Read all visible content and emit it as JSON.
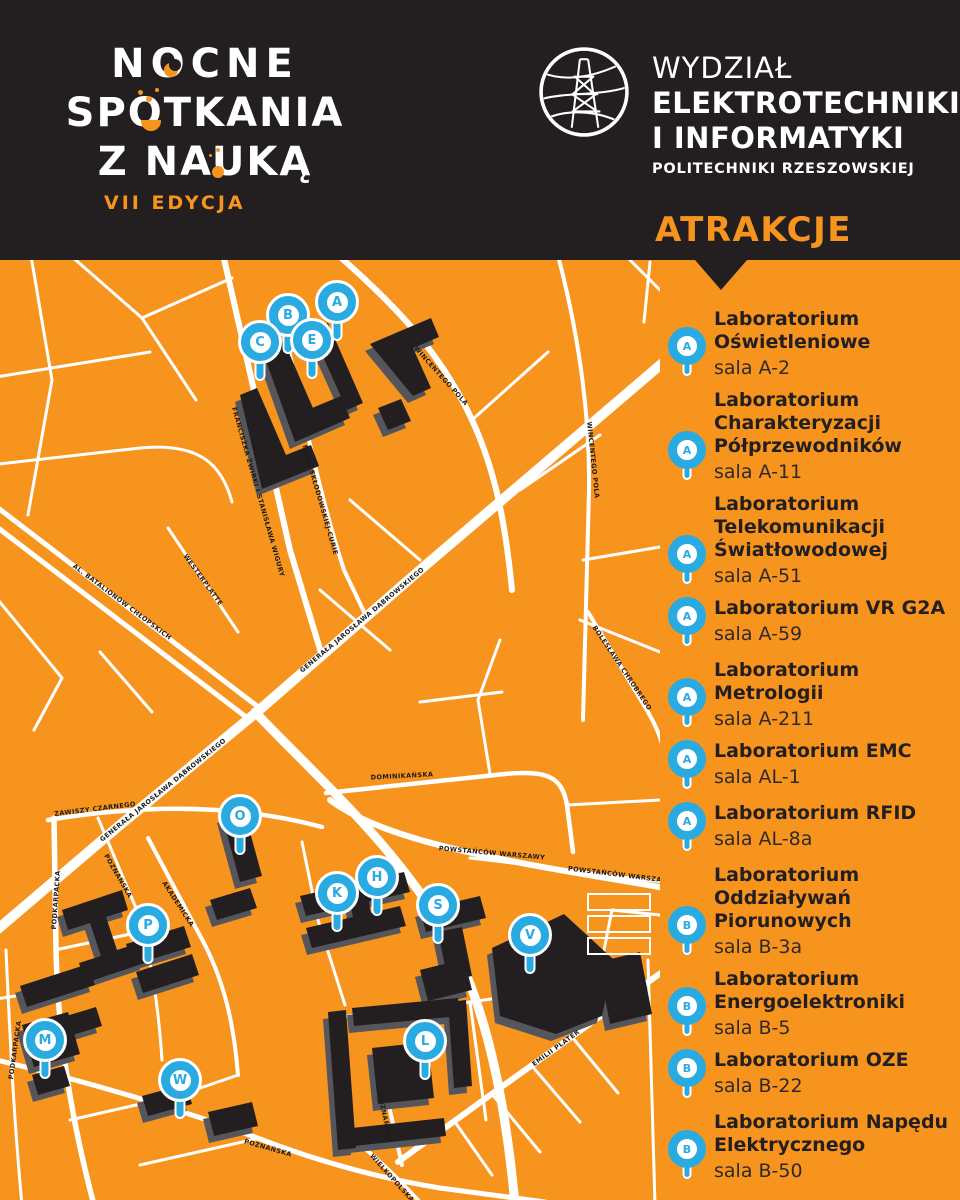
{
  "colors": {
    "orange": "#F7941E",
    "dark": "#231F20",
    "blue": "#29ABE2",
    "gray": "#54565B"
  },
  "header": {
    "event_logo": {
      "line1": "NOCNE",
      "line2": "SPOTKANIA",
      "line3": "Z NAUKĄ",
      "edition": "VII EDYCJA"
    },
    "faculty_logo": {
      "line1": "WYDZIAŁ",
      "line2": "ELEKTROTECHNIKI",
      "line3": "I INFORMATYKI",
      "line4": "POLITECHNIKI RZESZOWSKIEJ"
    }
  },
  "attractions": {
    "title": "ATRAKCJE",
    "items": [
      {
        "pin": "A",
        "name": "Laboratorium\nOświetleniowe",
        "room": "sala A-2"
      },
      {
        "pin": "A",
        "name": "Laboratorium\nCharakteryzacji\nPółprzewodników",
        "room": "sala A-11"
      },
      {
        "pin": "A",
        "name": "Laboratorium\nTelekomunikacji\nŚwiatłowodowej",
        "room": "sala A-51"
      },
      {
        "pin": "A",
        "name": "Laboratorium VR G2A",
        "room": "sala A-59"
      },
      {
        "pin": "A",
        "name": "Laboratorium\nMetrologii",
        "room": "sala A-211"
      },
      {
        "pin": "A",
        "name": "Laboratorium EMC",
        "room": "sala AL-1"
      },
      {
        "pin": "A",
        "name": "Laboratorium RFID",
        "room": "sala AL-8a"
      },
      {
        "pin": "B",
        "name": "Laboratorium\nOddziaływań\nPiorunowych",
        "room": "sala B-3a"
      },
      {
        "pin": "B",
        "name": "Laboratorium\nEnergoelektroniki",
        "room": "sala B-5"
      },
      {
        "pin": "B",
        "name": "Laboratorium OZE",
        "room": "sala B-22"
      },
      {
        "pin": "B",
        "name": "Laboratorium Napędu\nElektrycznego",
        "room": "sala B-50"
      }
    ]
  },
  "map": {
    "markers": [
      {
        "letter": "A",
        "x": 337,
        "y": 42
      },
      {
        "letter": "B",
        "x": 288,
        "y": 55
      },
      {
        "letter": "C",
        "x": 260,
        "y": 82
      },
      {
        "letter": "E",
        "x": 312,
        "y": 80
      },
      {
        "letter": "O",
        "x": 240,
        "y": 556
      },
      {
        "letter": "P",
        "x": 148,
        "y": 665
      },
      {
        "letter": "K",
        "x": 337,
        "y": 633
      },
      {
        "letter": "H",
        "x": 377,
        "y": 617
      },
      {
        "letter": "S",
        "x": 438,
        "y": 645
      },
      {
        "letter": "V",
        "x": 530,
        "y": 675
      },
      {
        "letter": "M",
        "x": 45,
        "y": 780
      },
      {
        "letter": "W",
        "x": 180,
        "y": 820
      },
      {
        "letter": "L",
        "x": 425,
        "y": 781
      }
    ],
    "street_labels": [
      {
        "text": "FRANCISZKA ŻWIRKI I STANISŁAWA WIGURY",
        "x": 258,
        "y": 232,
        "rot": 74
      },
      {
        "text": "MARII SKŁODOWSKIEJ-CURIE",
        "x": 320,
        "y": 240,
        "rot": 74
      },
      {
        "text": "GENERAŁA JAROSŁAWA DĄBROWSKIEGO",
        "x": 362,
        "y": 360,
        "rot": -40
      },
      {
        "text": "GENERAŁA JAROSŁAWA DĄBROWSKIEGO",
        "x": 163,
        "y": 530,
        "rot": -39
      },
      {
        "text": "AL. BATALIONÓW CHŁOPSKICH",
        "x": 122,
        "y": 342,
        "rot": 37
      },
      {
        "text": "ZAWISZY CZARNEGO",
        "x": 95,
        "y": 549,
        "rot": -7
      },
      {
        "text": "WESTERPLATTE",
        "x": 203,
        "y": 320,
        "rot": 54
      },
      {
        "text": "WINCENTEGO POLA",
        "x": 441,
        "y": 116,
        "rot": 48
      },
      {
        "text": "WINCENTEGO POLA",
        "x": 593,
        "y": 200,
        "rot": 84
      },
      {
        "text": "DOMINIKAŃSKA",
        "x": 402,
        "y": 516,
        "rot": -3
      },
      {
        "text": "POWSTAŃCÓW WARSZAWY",
        "x": 492,
        "y": 593,
        "rot": 5
      },
      {
        "text": "POWSTAŃCÓW WARSZAWY",
        "x": 621,
        "y": 615,
        "rot": 7
      },
      {
        "text": "BOLESŁAWA CHROBREGO",
        "x": 622,
        "y": 408,
        "rot": 56
      },
      {
        "text": "EMILII PLATER",
        "x": 556,
        "y": 788,
        "rot": -36
      },
      {
        "text": "PODKARPACKA",
        "x": 56,
        "y": 640,
        "rot": -86
      },
      {
        "text": "POZNAŃSKA",
        "x": 118,
        "y": 616,
        "rot": 60
      },
      {
        "text": "AKADEMICKA",
        "x": 178,
        "y": 644,
        "rot": 57
      },
      {
        "text": "POZNAŃSKA",
        "x": 268,
        "y": 888,
        "rot": 16
      },
      {
        "text": "POZNAŃSKA",
        "x": 385,
        "y": 858,
        "rot": 78
      },
      {
        "text": "WIELKOPOLSKA",
        "x": 392,
        "y": 918,
        "rot": 48
      },
      {
        "text": "PODKARPACKA",
        "x": 15,
        "y": 790,
        "rot": -82
      }
    ]
  }
}
